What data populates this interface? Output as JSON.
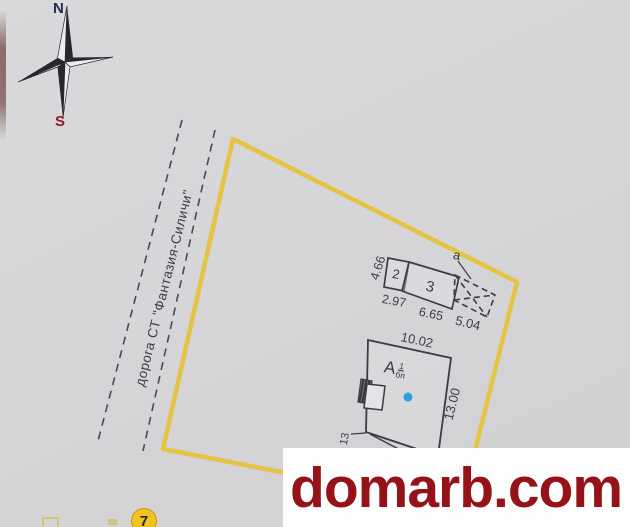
{
  "watermark": {
    "text": "domarb.com"
  },
  "compass": {
    "north": "N",
    "south": "S"
  },
  "road": {
    "label": "дорога СТ \"Фантазия-Силичи\""
  },
  "labels": {
    "building2": "2",
    "building3": "3",
    "shed": "а",
    "main_letter": "А",
    "main_sup": "1",
    "main_sub": "бп"
  },
  "dimensions": {
    "b2_height": "4.66",
    "b2_width": "2.97",
    "b3_width": "6.65",
    "shed_width": "5.04",
    "main_width": "10.02",
    "main_height": "13.00",
    "main_partial": "13"
  },
  "badge": {
    "number": "7"
  },
  "colors": {
    "boundary_yellow": "#e4c33c",
    "plan_line": "#3c3c42",
    "watermark_red": "#961219",
    "point_blue": "#2b9fda",
    "badge_yellow": "#f1c41d"
  }
}
